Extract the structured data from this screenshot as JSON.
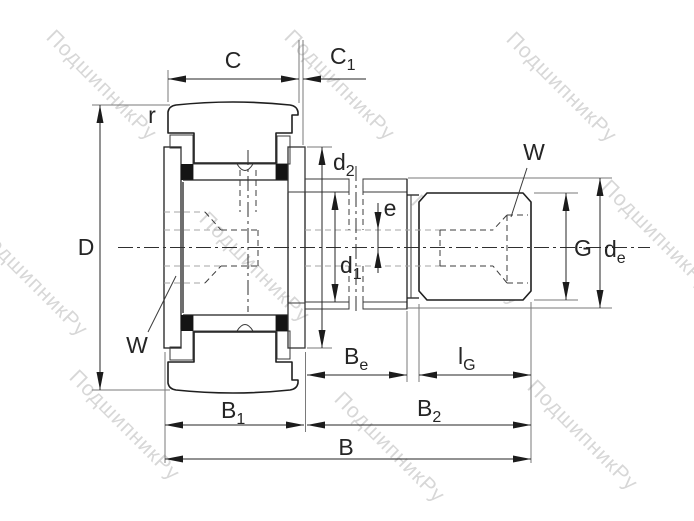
{
  "drawing": {
    "type": "bearing-cross-section",
    "description": "Stud-type track roller cam follower technical drawing"
  },
  "watermark": {
    "text": "ПодшипникРу"
  },
  "colors": {
    "line": "#1f1f1f",
    "dimension": "#262626",
    "extension": "#7a7a7a",
    "hidden": "#3c3c3c",
    "hidden_light": "#a6a6a6",
    "watermark": "#bfbfbf",
    "background": "#ffffff"
  },
  "labels": {
    "C": {
      "base": "C",
      "sub": ""
    },
    "C1": {
      "base": "C",
      "sub": "1"
    },
    "r": {
      "base": "r",
      "sub": ""
    },
    "D": {
      "base": "D",
      "sub": ""
    },
    "W_left": {
      "base": "W",
      "sub": ""
    },
    "W_right": {
      "base": "W",
      "sub": ""
    },
    "d2": {
      "base": "d",
      "sub": "2"
    },
    "e": {
      "base": "e",
      "sub": ""
    },
    "d1": {
      "base": "d",
      "sub": "1"
    },
    "G": {
      "base": "G",
      "sub": ""
    },
    "de": {
      "base": "d",
      "sub": "e"
    },
    "Be": {
      "base": "B",
      "sub": "e"
    },
    "lG": {
      "base": "l",
      "sub": "G"
    },
    "B1": {
      "base": "B",
      "sub": "1"
    },
    "B2": {
      "base": "B",
      "sub": "2"
    },
    "B": {
      "base": "B",
      "sub": ""
    }
  }
}
